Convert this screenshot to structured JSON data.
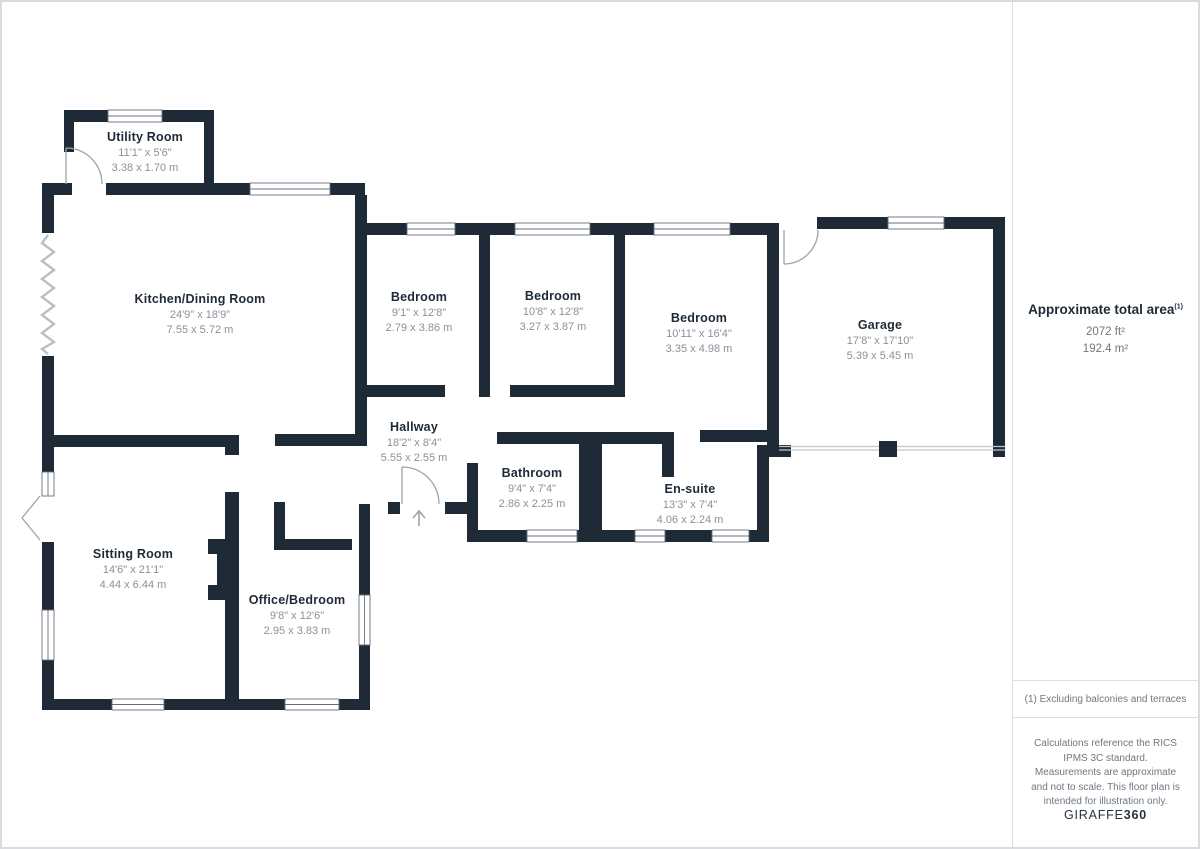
{
  "plan": {
    "rooms": [
      {
        "id": "utility-room",
        "name": "Utility Room",
        "imperial": "11'1\" x 5'6\"",
        "metric": "3.38 x 1.70 m"
      },
      {
        "id": "kitchen-dining-room",
        "name": "Kitchen/Dining Room",
        "imperial": "24'9\" x 18'9\"",
        "metric": "7.55 x 5.72 m"
      },
      {
        "id": "bedroom-1",
        "name": "Bedroom",
        "imperial": "9'1\" x 12'8\"",
        "metric": "2.79 x 3.86 m"
      },
      {
        "id": "bedroom-2",
        "name": "Bedroom",
        "imperial": "10'8\" x 12'8\"",
        "metric": "3.27 x 3.87 m"
      },
      {
        "id": "bedroom-3",
        "name": "Bedroom",
        "imperial": "10'11\" x 16'4\"",
        "metric": "3.35 x 4.98 m"
      },
      {
        "id": "garage",
        "name": "Garage",
        "imperial": "17'8\" x 17'10\"",
        "metric": "5.39 x 5.45 m"
      },
      {
        "id": "hallway",
        "name": "Hallway",
        "imperial": "18'2\" x 8'4\"",
        "metric": "5.55 x 2.55 m"
      },
      {
        "id": "bathroom",
        "name": "Bathroom",
        "imperial": "9'4\" x 7'4\"",
        "metric": "2.86 x 2.25 m"
      },
      {
        "id": "en-suite",
        "name": "En-suite",
        "imperial": "13'3\" x 7'4\"",
        "metric": "4.06 x 2.24 m"
      },
      {
        "id": "sitting-room",
        "name": "Sitting Room",
        "imperial": "14'6\" x 21'1\"",
        "metric": "4.44 x 6.44 m"
      },
      {
        "id": "office-bedroom",
        "name": "Office/Bedroom",
        "imperial": "9'8\" x 12'6\"",
        "metric": "2.95 x 3.83 m"
      }
    ],
    "icons": {
      "entrance_arrow": "up-arrow"
    }
  },
  "sidebar": {
    "total_area_title": "Approximate total area",
    "total_area_superscript": "(1)",
    "area_ft": "2072 ft²",
    "area_m": "192.4 m²",
    "footnote": "(1) Excluding balconies and terraces",
    "disclaimer": "Calculations reference the RICS IPMS 3C standard. Measurements are approximate and not to scale. This floor plan is intended for illustration only.",
    "brand_name": "GIRAFFE",
    "brand_number": "360"
  },
  "colors": {
    "wall": "#1f2a37",
    "room_name_text": "#1f2a37",
    "dimension_text": "#8a919b",
    "panel_text": "#6f7780",
    "page_border": "#d9dbde",
    "door_symbol": "#9aa3ad"
  }
}
